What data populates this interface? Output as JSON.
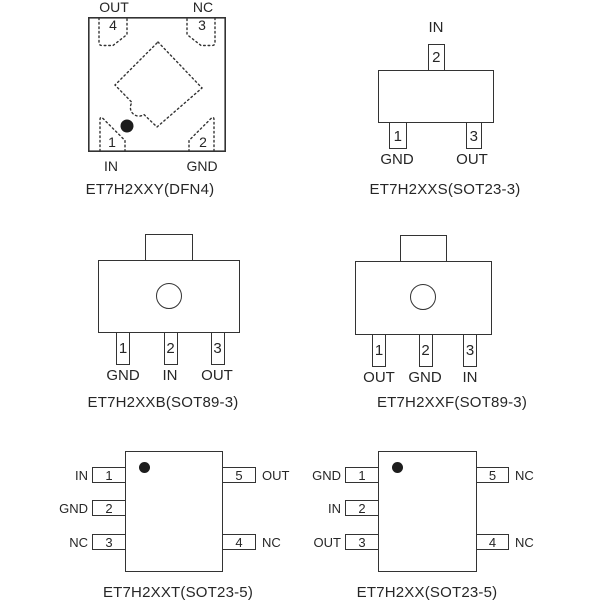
{
  "colors": {
    "line": "#333333",
    "text": "#262626",
    "background": "#ffffff"
  },
  "diagrams": {
    "dfn4": {
      "title": "ET7H2XXY(DFN4)",
      "top_left_label": "OUT",
      "top_right_label": "NC",
      "bottom_left_label": "IN",
      "bottom_right_label": "GND",
      "pin1": "1",
      "pin2": "2",
      "pin3": "3",
      "pin4": "4"
    },
    "sot23_3": {
      "title": "ET7H2XXS(SOT23-3)",
      "top_pin": {
        "num": "2",
        "label": "IN"
      },
      "bottom_left_pin": {
        "num": "1",
        "label": "GND"
      },
      "bottom_right_pin": {
        "num": "3",
        "label": "OUT"
      }
    },
    "sot89_b": {
      "title": "ET7H2XXB(SOT89-3)",
      "pins": [
        {
          "num": "1",
          "label": "GND"
        },
        {
          "num": "2",
          "label": "IN"
        },
        {
          "num": "3",
          "label": "OUT"
        }
      ]
    },
    "sot89_f": {
      "title": "ET7H2XXF(SOT89-3)",
      "pins": [
        {
          "num": "1",
          "label": "OUT"
        },
        {
          "num": "2",
          "label": "GND"
        },
        {
          "num": "3",
          "label": "IN"
        }
      ]
    },
    "sot23_5t": {
      "title": "ET7H2XXT(SOT23-5)",
      "left_pins": [
        {
          "num": "1",
          "label": "IN"
        },
        {
          "num": "2",
          "label": "GND"
        },
        {
          "num": "3",
          "label": "NC"
        }
      ],
      "right_pins": [
        {
          "num": "5",
          "label": "OUT"
        },
        {
          "num": "4",
          "label": "NC"
        }
      ]
    },
    "sot23_5x": {
      "title": "ET7H2XX(SOT23-5)",
      "left_pins": [
        {
          "num": "1",
          "label": "GND"
        },
        {
          "num": "2",
          "label": "IN"
        },
        {
          "num": "3",
          "label": "OUT"
        }
      ],
      "right_pins": [
        {
          "num": "5",
          "label": "NC"
        },
        {
          "num": "4",
          "label": "NC"
        }
      ]
    }
  }
}
